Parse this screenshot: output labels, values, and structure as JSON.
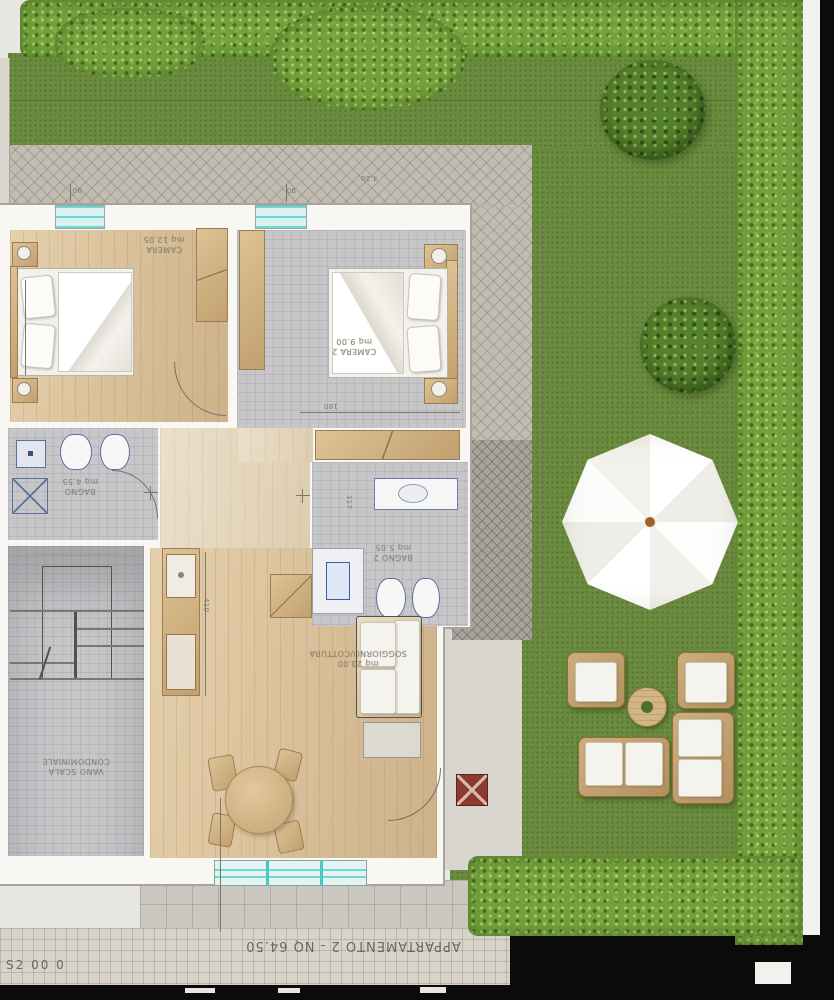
{
  "sheet": {
    "scale_note": "S2 00 0",
    "title": "APPARTAMENTO 2 - NQ 64.50"
  },
  "rooms": {
    "bedroom1": {
      "label": "CAMERA",
      "area": "mq 12.05"
    },
    "bedroom2": {
      "label": "CAMERA 2",
      "area": "mq 9.00"
    },
    "bath1": {
      "label": "BAGNO",
      "area": "mq 4.55"
    },
    "bath2": {
      "label": "BAGNO 2",
      "area": "mq 5.05"
    },
    "living": {
      "label": "SOGGIORNO/COTTURA",
      "area": "mq 23.00"
    },
    "stairs": {
      "label": "VANO SCALA",
      "area": "CONDOMINIALE"
    }
  },
  "dimensions": {
    "path_width": "4.20",
    "tick_left": "90",
    "tick_right": "90",
    "bed2_width": "180",
    "kitchen_len": "410",
    "corridor": "117"
  },
  "colors": {
    "grass": "#6a8b3e",
    "hedge": "#73a03b",
    "glass": "#6fd8d4",
    "wood_floor": "#dcc49c",
    "umbrella": "#ffffff",
    "grill": "#8a3a2e"
  }
}
